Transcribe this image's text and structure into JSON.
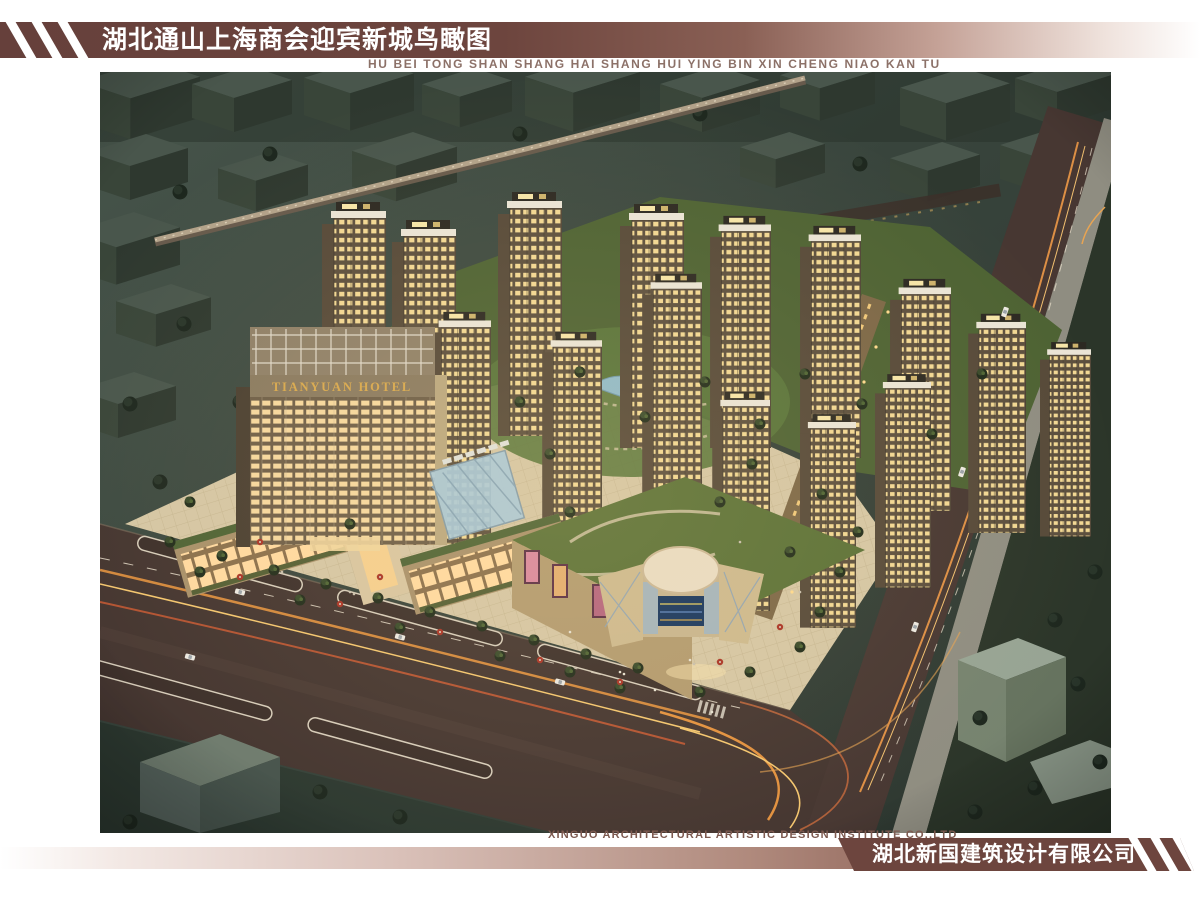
{
  "header": {
    "title": "湖北通山上海商会迎宾新城鸟瞰图",
    "subtitle_pinyin": "HU BEI TONG SHAN SHANG HAI SHANG HUI YING BIN XIN CHENG NIAO KAN TU"
  },
  "footer": {
    "company_en": "XINGUO ARCHITECTURAL ARTISTIC DESIGN INSTITUTE CO.,LTD",
    "company_cn": "湖北新国建筑设计有限公司"
  },
  "artwork": {
    "hotel_sign": "TIANYUAN HOTEL"
  },
  "colors": {
    "brand_maroon": "#6d453e",
    "bar_gradient_light": "#f4ece9",
    "hotel_sign_gold": "#d8a84e",
    "night_city_base": "#36423a",
    "road_dark": "#45352f",
    "plaza_tan": "#d5c6a4",
    "lawn_green": "#55683a",
    "lit_window": "#f2d894",
    "pond_blue": "#8fb9c9"
  }
}
